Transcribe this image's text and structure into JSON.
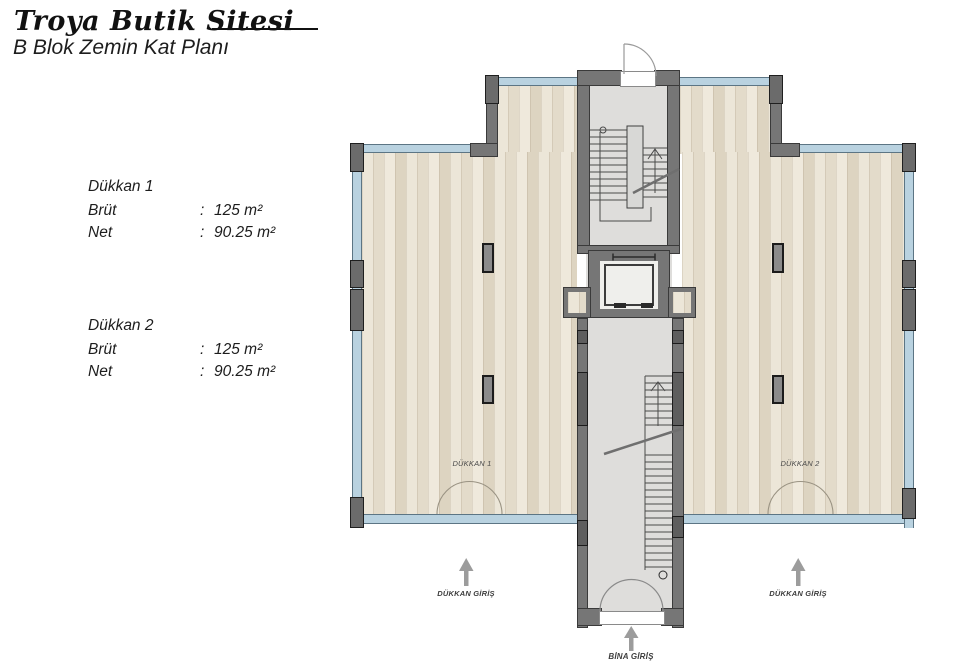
{
  "header": {
    "title": "Troya Butik Sitesi",
    "subtitle": "B Blok Zemin Kat Planı"
  },
  "units": [
    {
      "name": "Dükkan 1",
      "rows": [
        {
          "label": "Brüt",
          "sep": ":",
          "value": "125 m²"
        },
        {
          "label": "Net",
          "sep": ":",
          "value": "90.25 m²"
        }
      ]
    },
    {
      "name": "Dükkan 2",
      "rows": [
        {
          "label": "Brüt",
          "sep": ":",
          "value": "125 m²"
        },
        {
          "label": "Net",
          "sep": ":",
          "value": "90.25 m²"
        }
      ]
    }
  ],
  "plan": {
    "rooms": [
      {
        "label": "DÜKKAN 1"
      },
      {
        "label": "DÜKKAN 2"
      }
    ],
    "entrances": {
      "shop_left": "DÜKKAN GİRİŞ",
      "shop_right": "DÜKKAN GİRİŞ",
      "building": "BİNA GİRİŞ"
    },
    "colors": {
      "wall": "#767676",
      "glass": "#b9d2e0",
      "wood": "#e9e2d3",
      "stair_floor": "#dedddb",
      "arrow": "#9c9c9c"
    }
  }
}
